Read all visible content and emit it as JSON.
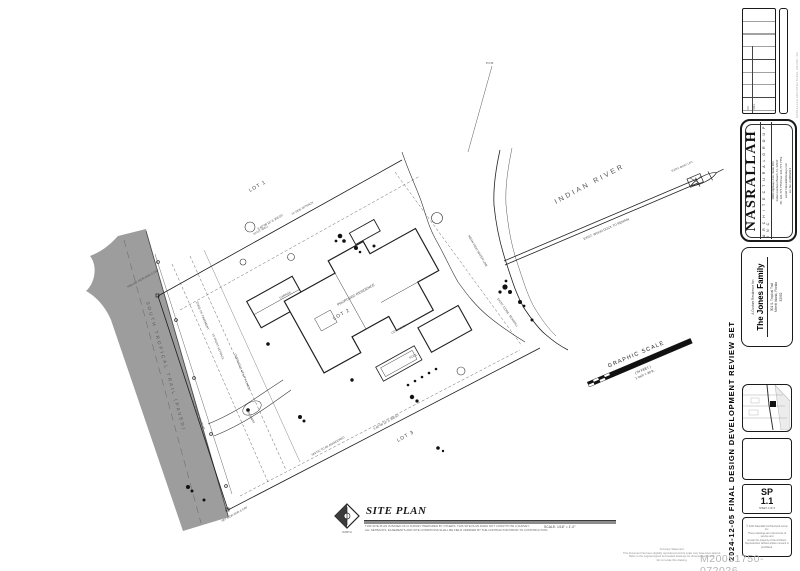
{
  "sheet": {
    "review_set_label": "2024-12-05 FINAL DESIGN DEVELOPMENT REVIEW SET",
    "watermark": "M20051750-072026",
    "edge_text": "NASRALLAH ARCHITECTURAL GROUP INC",
    "disclaimer": {
      "line1": "Accuracy Statement:",
      "line2": "This document has been digitally reproduced and its scale may have been altered.",
      "line3": "Refer to the original signed and sealed drawings for dimensional control.",
      "line4": "Do not scale this drawing."
    }
  },
  "title_block": {
    "revisions": {
      "col1": "NO.",
      "col2": "DATE"
    },
    "firm": {
      "name": "NASRALLAH",
      "tagline": "A R C H I T E C T U R A L   G R O U P   I N C",
      "line1": "1900 Highway A1A, Suite 103",
      "line2": "Indian Harbour Beach, FL 32937",
      "line3": "Ph: 321.777.7750   Fax: 321.777.7752",
      "line4": "email: NasrallahGroup.com",
      "line5": "Lic. No. AA0002613"
    },
    "project": {
      "prefix": "A Custom Residence for:",
      "name": "The Jones Family",
      "line1": "301 S. Tropical Trail",
      "line2": "Merritt Island, Florida",
      "line3": "32952"
    },
    "sheet_no": {
      "prefix": "SP",
      "number": "1.1",
      "note": "SHEET 1 OF 8"
    },
    "copyright": {
      "line1": "© 2024 Nasrallah Architectural Group Inc.",
      "line2": "These drawings are instruments of service and",
      "line3": "remain the property of the Architect.",
      "line4": "Reproduction without written consent is prohibited."
    }
  },
  "titlebar": {
    "title": "SITE PLAN",
    "north_label": "NORTH",
    "scale": "SCALE: 1/16\" = 1'-0\"",
    "note1": "THIS SITE PLAN IS BASED ON A SURVEY PREPARED BY OTHERS.  THIS SITE PLAN DOES NOT CONSTITUTE A SURVEY.",
    "note2": "ALL SETBACKS, EASEMENTS AND SITE CONDITIONS SHALL BE FIELD VERIFIED BY THE CONTRACTOR PRIOR TO CONSTRUCTION."
  },
  "plan": {
    "river_label": "INDIAN RIVER",
    "road_label": "SOUTH TROPICAL TRAIL (PAVED)",
    "lot1": "LOT 1",
    "lot2": "LOT 2",
    "lot3": "LOT 3",
    "graphic_scale": {
      "title": "GRAPHIC SCALE",
      "units": "( IN FEET )",
      "ratio": "1 inch = 30 ft."
    },
    "annotations": [
      "EXIST. WOOD DOCK TO REMAIN",
      "MEAN HIGH WATER LINE",
      "EXIST. CONC. SEAWALL",
      "EDGE OF PAVEMENT",
      "OVERHEAD UTILITY LINES",
      "FND 5/8\" IRON ROD & CAP",
      "SET IRON ROD & CAP",
      "PROPOSED RESIDENCE",
      "GARAGE",
      "POOL",
      "COV. PORCH",
      "DRIVEWAY",
      "EXIST. WELL",
      "SEPTIC TO BE ABANDONED",
      "25' FRONT SETBACK",
      "10' SIDE SETBACK",
      "S 60°06'18\" E   300.00'",
      "S 60°06'18\" E   298.50'",
      "N 15°28'43\" W   100.00'",
      "P.O.B.",
      "EXIST. BOAT LIFT"
    ]
  },
  "colors": {
    "road_gray": "#9d9d9d",
    "line": "#222222",
    "watermark_gray": "#b5b5b5"
  }
}
